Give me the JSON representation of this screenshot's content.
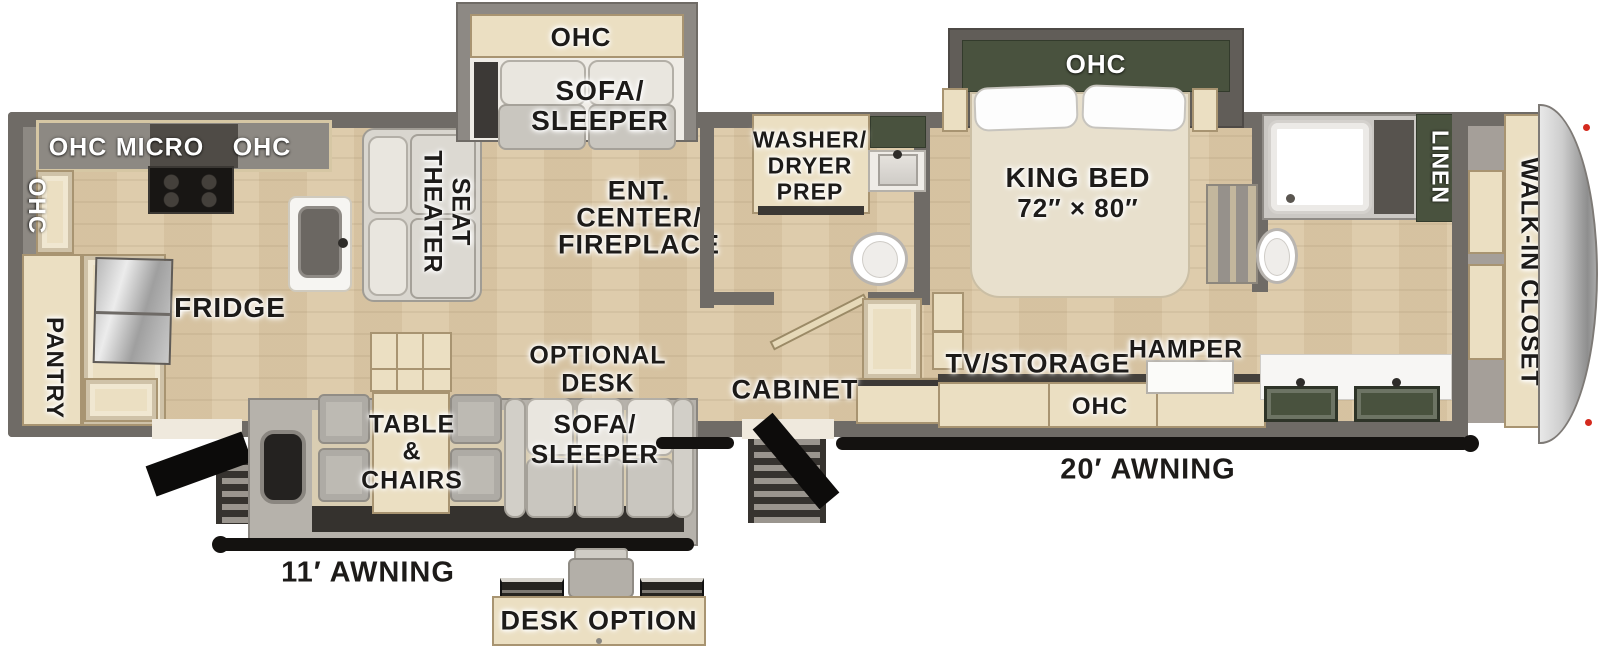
{
  "colors": {
    "wall": "#6f6b66",
    "slide_wall": "#8d8984",
    "wood_floor": "#dcc9a7",
    "cabinet_wood": "#ebdfc2",
    "dark_green": "#49523e",
    "awning_bar": "#141210",
    "label_text": "#1d1b19",
    "marker_light": "#d42a1e"
  },
  "rooms": {
    "kitchen": {
      "ohc_corner": "OHC",
      "ohc_top_left": "OHC",
      "micro": "MICRO",
      "ohc_top_right": "OHC",
      "pantry": "PANTRY",
      "fridge": "FRIDGE"
    },
    "living": {
      "theater_line1": "THEATER",
      "theater_line2": "SEAT",
      "slide_ohc": "OHC",
      "slide_sofa_line1": "SOFA/",
      "slide_sofa_line2": "SLEEPER",
      "ent_line1": "ENT.",
      "ent_line2": "CENTER/",
      "ent_line3": "FIREPLACE"
    },
    "mid_bath": {
      "washer_line1": "WASHER/",
      "washer_line2": "DRYER",
      "washer_line3": "PREP"
    },
    "hall": {
      "cabinet": "CABINET"
    },
    "bedroom": {
      "ohc": "OHC",
      "bed_line1": "KING BED",
      "bed_line2": "72″ × 80″",
      "tv_storage": "TV/STORAGE",
      "console_ohc": "OHC",
      "hamper": "HAMPER"
    },
    "rear_bath": {
      "linen": "LINEN"
    },
    "closet": {
      "label": "WALK-IN CLOSET"
    },
    "dinette": {
      "table_line1": "TABLE",
      "table_line2": "&",
      "table_line3": "CHAIRS",
      "optional_line1": "OPTIONAL",
      "optional_line2": "DESK",
      "sofa_line1": "SOFA/",
      "sofa_line2": "SLEEPER"
    },
    "exterior": {
      "awning_left": "11′ AWNING",
      "awning_right": "20′ AWNING",
      "desk_option": "DESK OPTION"
    }
  }
}
